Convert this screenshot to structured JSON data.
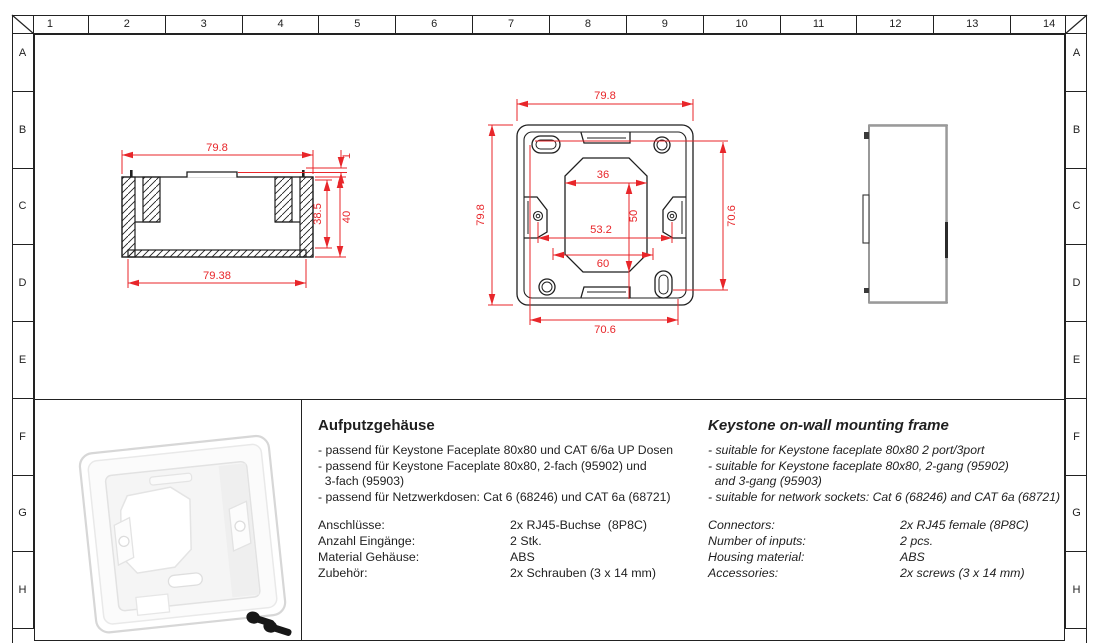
{
  "frame": {
    "columns": [
      "1",
      "2",
      "3",
      "4",
      "5",
      "6",
      "7",
      "8",
      "9",
      "10",
      "11",
      "12",
      "13",
      "14"
    ],
    "rows": [
      "A",
      "B",
      "C",
      "D",
      "E",
      "F",
      "G",
      "H"
    ]
  },
  "views": {
    "side": {
      "width_top": "79.8",
      "pin_height": "1",
      "inner_height": "38.5",
      "total_height": "40",
      "width_bottom": "79.38"
    },
    "front": {
      "width": "79.8",
      "height": "79.8",
      "opening_top": "36",
      "opening_height": "50",
      "screw_spacing": "53.2",
      "opening_bottom": "60",
      "hole_spacing_h": "70.6",
      "hole_spacing_v": "70.6"
    }
  },
  "info_de": {
    "title": "Aufputzgehäuse",
    "bullets": [
      "- passend für Keystone Faceplate 80x80 und CAT 6/6a UP Dosen",
      "- passend für Keystone Faceplate 80x80, 2-fach (95902) und",
      "  3-fach (95903)",
      "- passend für Netzwerkdosen: Cat 6 (68246) und CAT 6a (68721)"
    ],
    "specs": [
      {
        "label": "Anschlüsse:",
        "value": "2x RJ45-Buchse  (8P8C)"
      },
      {
        "label": "Anzahl Eingänge:",
        "value": "2 Stk."
      },
      {
        "label": "Material Gehäuse:",
        "value": "ABS"
      },
      {
        "label": "Zubehör:",
        "value": "2x Schrauben (3 x 14 mm)"
      }
    ]
  },
  "info_en": {
    "title": "Keystone on-wall mounting frame",
    "bullets": [
      "- suitable for Keystone faceplate 80x80 2 port/3port",
      "- suitable for Keystone faceplate 80x80, 2-gang (95902)",
      "  and 3-gang (95903)",
      "- suitable for network sockets: Cat 6 (68246) and CAT 6a (68721)"
    ],
    "specs": [
      {
        "label": "Connectors:",
        "value": "2x RJ45 female (8P8C)"
      },
      {
        "label": "Number of inputs:",
        "value": "2 pcs."
      },
      {
        "label": "Housing material:",
        "value": "ABS"
      },
      {
        "label": "Accessories:",
        "value": "2x screws (3 x 14 mm)"
      }
    ]
  },
  "colors": {
    "dimension_red": "#e8262a",
    "line_black": "#1f1f1f"
  }
}
